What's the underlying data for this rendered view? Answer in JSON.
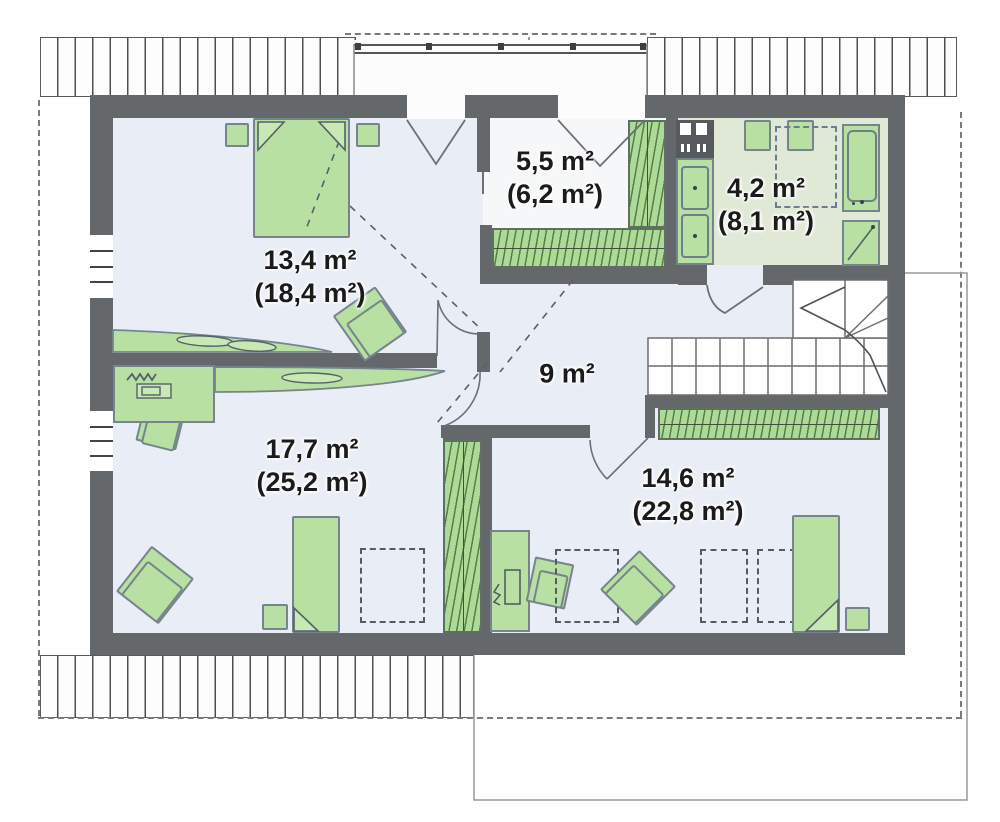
{
  "plan_title": "Attic floor plan",
  "rooms": [
    {
      "name": "bedroom-top-left",
      "area": "13,4 m²",
      "area_total": "(18,4 m²)"
    },
    {
      "name": "wardrobe-closet",
      "area": "5,5 m²",
      "area_total": "(6,2 m²)"
    },
    {
      "name": "bathroom",
      "area": "4,2 m²",
      "area_total": "(8,1 m²)"
    },
    {
      "name": "hall",
      "area": "9 m²",
      "area_total": ""
    },
    {
      "name": "bedroom-bottom-left",
      "area": "17,7 m²",
      "area_total": "(25,2 m²)"
    },
    {
      "name": "bedroom-bottom-right",
      "area": "14,6 m²",
      "area_total": "(22,8 m²)"
    }
  ],
  "colors": {
    "wall": "#64686b",
    "floor": "#e9edf5",
    "closet_floor": "#f6f7f8",
    "bathroom_floor": "#dfe9d6",
    "furniture_green": "#b7e0a2",
    "hatch_green": "#abdb94",
    "line_dark": "#4c5258",
    "text": "#1b1b1b"
  }
}
